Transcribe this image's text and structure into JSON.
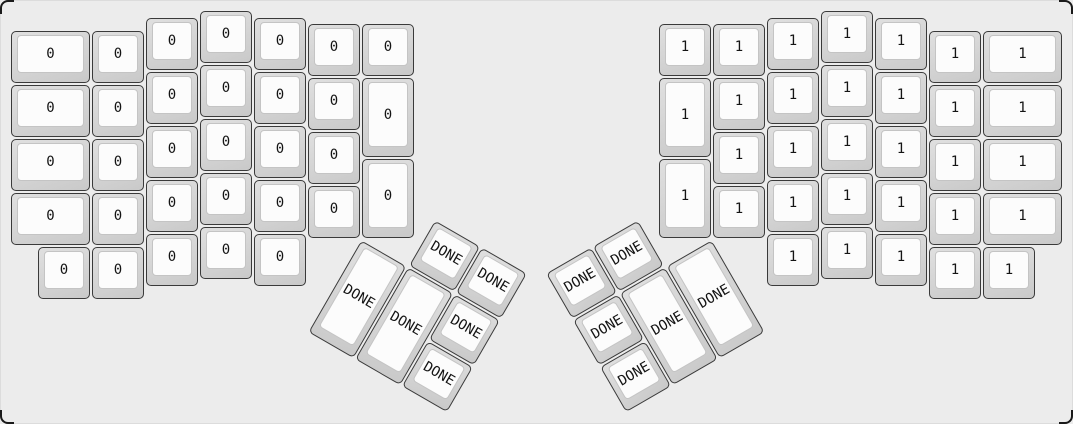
{
  "keyboard": {
    "left_half": {
      "name": "left-half",
      "keys": [
        "0",
        "0",
        "0",
        "0",
        "0",
        "0",
        "0",
        "0",
        "0",
        "0",
        "0",
        "0",
        "0",
        "0",
        "0",
        "0",
        "0",
        "0",
        "0",
        "0",
        "0",
        "0",
        "0",
        "0",
        "0",
        "0",
        "0",
        "0",
        "0",
        "0",
        "0",
        "0"
      ]
    },
    "right_half": {
      "name": "right-half",
      "keys": [
        "1",
        "1",
        "1",
        "1",
        "1",
        "1",
        "1",
        "1",
        "1",
        "1",
        "1",
        "1",
        "1",
        "1",
        "1",
        "1",
        "1",
        "1",
        "1",
        "1",
        "1",
        "1",
        "1",
        "1",
        "1",
        "1",
        "1",
        "1",
        "1",
        "1",
        "1",
        "1"
      ]
    },
    "left_thumb_cluster": {
      "name": "left-thumb-cluster",
      "keys": [
        "DONE",
        "DONE",
        "DONE",
        "DONE",
        "DONE",
        "DONE"
      ]
    },
    "right_thumb_cluster": {
      "name": "right-thumb-cluster",
      "keys": [
        "DONE",
        "DONE",
        "DONE",
        "DONE",
        "DONE",
        "DONE"
      ]
    }
  },
  "colors": {
    "canvas_background": "#ececec",
    "case_corner": "#1a1a1a",
    "keycap_base_highlight": "#e0e0e0",
    "keycap_base_shadow": "#c9c9c9",
    "keycap_border": "#3a3a3a",
    "keycap_top": "#fcfcfc",
    "keycap_top_border": "#c4c4c4",
    "legend_color": "#141414"
  }
}
